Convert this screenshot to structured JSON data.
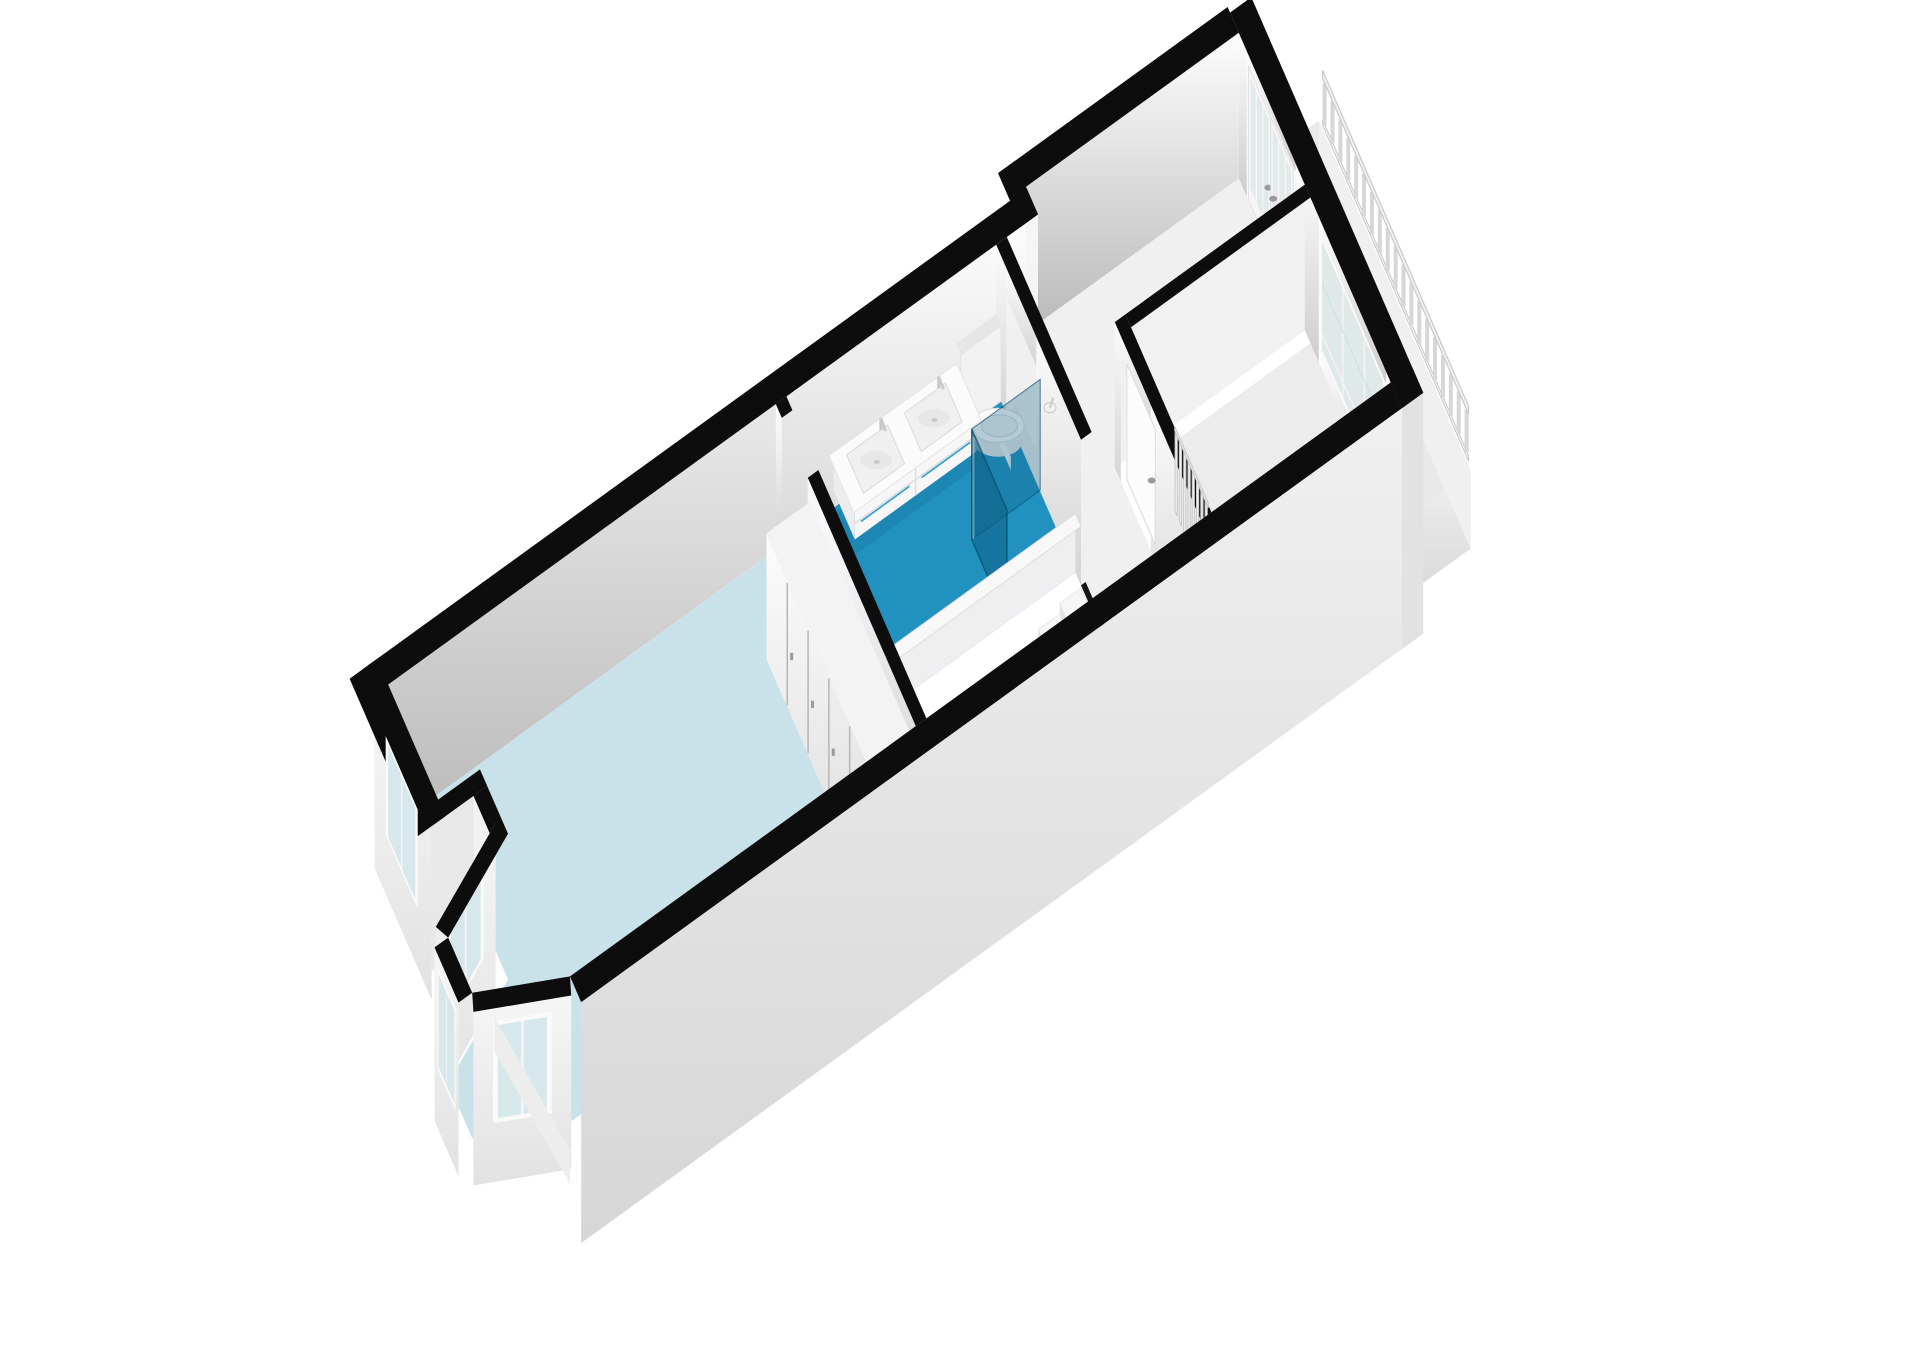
{
  "meta": {
    "kind": "3d-floorplan-render",
    "width": 1920,
    "height": 1358,
    "visible_text": []
  },
  "palette": {
    "bg": "#ffffff",
    "wallTop": "#0d0d0d",
    "cutEdge": "#161616",
    "capFace": "#f7f7f7",
    "jogFace": "#f5f5f5",
    "floorBedroom": "#c9e2ea",
    "floorBathroom": "#2191c0",
    "floorHall": "#f0f0f0",
    "floorRoom": "#ececec",
    "floorBalcony": "#e9e9e9",
    "glass": "#d7e8ec",
    "glassDoor": "#e1ecea",
    "glassRoom": "#dfeae8",
    "frame": "#fafafa",
    "mullion": "#f3f3f3",
    "showerGlass": "rgba(13,95,131,0.55)",
    "showerGlassReturn": "rgba(13,95,131,0.30)",
    "showerEdge": "rgba(10,75,104,0.7)",
    "accentBlue": "#2f9fd0",
    "accentGreen": "#8fbf7a",
    "fixture": "#f9f9f9",
    "fixtureShade": "#e4e4e4",
    "fixtureDark": "#d6d6d6",
    "seam": "#b5b5b5",
    "handle": "#9a9a9a",
    "stairTread": "#f6f6f6",
    "stairRiser": "#e2e2e2",
    "stairSide": "#ececec",
    "parapetFace": "#efefef",
    "parapetTop": "#f8f8f8",
    "parapetEdge": "#dddddd",
    "railFill": "#f1f1f1",
    "railStroke": "#c9c9c9",
    "balusterStroke": "#d7d7d7",
    "radFin": "#f2f2f2",
    "radStroke": "#c6c6c6",
    "toiletBase": "#e7e7e7",
    "porcelain": "#fbfbfb",
    "porcelainStroke": "#dedede",
    "seatFill": "#f0f2f2",
    "drainFill": "#eef4f6",
    "drainStroke": "#a9c2cb",
    "drainDot": "#87a7b1",
    "underShadow": "rgba(0,0,0,0.07)",
    "gradients": [
      [
        "gNW",
        "#fdfdfd",
        "#b9b9b9"
      ],
      [
        "gFace",
        "#fefefe",
        "#cdcdcd"
      ],
      [
        "gAcross",
        "#fbfbfb",
        "#d4d4d4"
      ],
      [
        "gInnerSE",
        "#f4f4f4",
        "#c2c2c2"
      ],
      [
        "gOuter",
        "#f0f0f0",
        "#d6d6d6"
      ],
      [
        "gCloset",
        "#fcfcfc",
        "#dcdcdc"
      ],
      [
        "gBayOuter",
        "#f6f6f6",
        "#e2e2e2"
      ],
      [
        "gVoid",
        "#b5b5b5",
        "#7f7f7f"
      ]
    ]
  },
  "rooms": [
    {
      "name": "bedroom",
      "floor": "floorBedroom"
    },
    {
      "name": "bathroom",
      "floor": "floorBathroom"
    },
    {
      "name": "hallway",
      "floor": "floorHall"
    },
    {
      "name": "top-room",
      "floor": "floorRoom"
    },
    {
      "name": "balcony",
      "floor": "floorBalcony"
    },
    {
      "name": "stairwell",
      "floor": "gVoid"
    }
  ],
  "fixtures": {
    "wardrobe": {
      "doors": 5,
      "handles": 4
    },
    "staircase": {
      "visible_steps": 6
    },
    "vanity": {
      "basins": 2,
      "accent": "accentBlue",
      "trim": "accentGreen",
      "drawer_rows": 2
    },
    "toilet": {
      "type": "wall-hung"
    },
    "shower": {
      "panels": 2,
      "drain": true,
      "head": true
    },
    "radiator": {
      "fins": 8
    },
    "balcony_railing": {
      "balusters": 19
    },
    "balcony_door": {
      "leaves": 2,
      "panes_per_leaf": 3
    },
    "windows": {
      "bay_segments": 3,
      "side_window": 1,
      "room_window_mullions": 2
    }
  }
}
